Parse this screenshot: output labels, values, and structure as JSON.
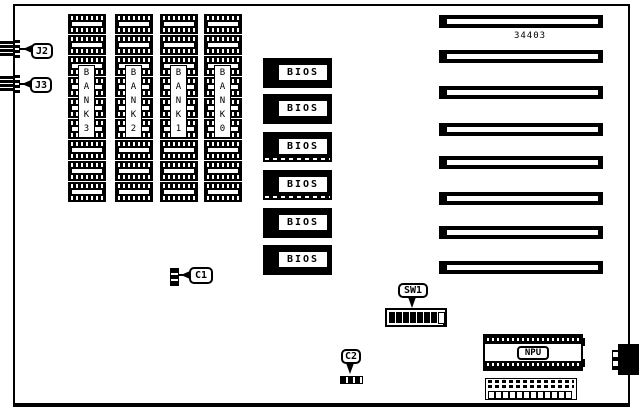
{
  "board": {
    "number": "34403",
    "ink": "#000000",
    "background": "#ffffff"
  },
  "left_connectors": [
    {
      "label": "J2"
    },
    {
      "label": "J3"
    }
  ],
  "memory": {
    "chips_per_bank": 9,
    "banks": [
      {
        "label": "BANK 3"
      },
      {
        "label": "BANK 2"
      },
      {
        "label": "BANK 1"
      },
      {
        "label": "BANK 0"
      }
    ]
  },
  "bios": {
    "label": "BIOS",
    "count": 6,
    "socketed_rows": [
      3,
      4
    ]
  },
  "expansion_slots": {
    "count": 8
  },
  "dip_switch": {
    "label": "SW1",
    "segments_total": 8,
    "segments_filled": 7
  },
  "components": {
    "c1_label": "C1",
    "c2_label": "C2",
    "npu_label": "NPU"
  },
  "bottom_header": {
    "pin_count": 12
  }
}
